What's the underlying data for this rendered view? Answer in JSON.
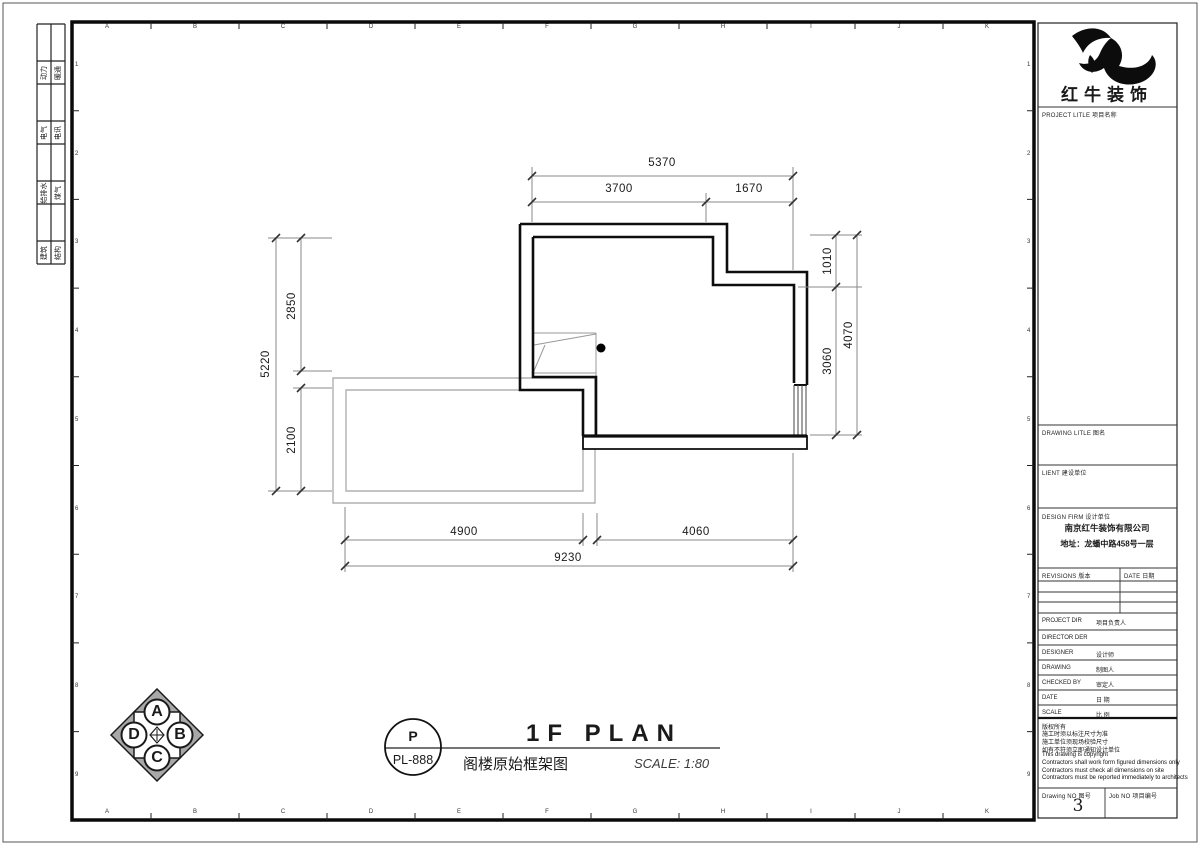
{
  "sheet": {
    "grid_letters": [
      "A",
      "B",
      "C",
      "D",
      "E",
      "F",
      "G",
      "H",
      "I",
      "J",
      "K"
    ],
    "grid_numbers": [
      "1",
      "2",
      "3",
      "4",
      "5",
      "6",
      "7",
      "8",
      "9"
    ],
    "disciplines": [
      {
        "left": "动力",
        "right": "暖通"
      },
      {
        "left": "电气",
        "right": "电讯"
      },
      {
        "left": "给排水",
        "right": "煤气"
      },
      {
        "left": "建筑",
        "right": "结构"
      }
    ]
  },
  "plan": {
    "dimension_labels": [
      {
        "text": "5370",
        "x": 662,
        "y": 163,
        "rot": 0
      },
      {
        "text": "3700",
        "x": 619,
        "y": 189,
        "rot": 0
      },
      {
        "text": "1670",
        "x": 749,
        "y": 189,
        "rot": 0
      },
      {
        "text": "5220",
        "x": 266,
        "y": 364,
        "rot": -90
      },
      {
        "text": "2850",
        "x": 292,
        "y": 306,
        "rot": -90
      },
      {
        "text": "2100",
        "x": 292,
        "y": 440,
        "rot": -90
      },
      {
        "text": "1010",
        "x": 828,
        "y": 261,
        "rot": -90
      },
      {
        "text": "3060",
        "x": 828,
        "y": 361,
        "rot": -90
      },
      {
        "text": "4070",
        "x": 849,
        "y": 335,
        "rot": -90
      },
      {
        "text": "4900",
        "x": 464,
        "y": 532,
        "rot": 0
      },
      {
        "text": "4060",
        "x": 696,
        "y": 532,
        "rot": 0
      },
      {
        "text": "9230",
        "x": 568,
        "y": 558,
        "rot": 0
      }
    ]
  },
  "compass": {
    "letters": [
      "A",
      "B",
      "C",
      "D"
    ]
  },
  "footer": {
    "stamp_top": "P",
    "stamp_no": "PL-888",
    "title": "1F PLAN",
    "subtitle": "阁楼原始框架图",
    "scale_label": "SCALE: 1:80"
  },
  "titleblock": {
    "logo_text": "红牛装饰",
    "project_title_label": "PROJECT LITLE 项目名称",
    "drawing_title_label": "DRAWING LITLE 图名",
    "client_label": "LIENT 建设单位",
    "design_firm_label": "DESIGN FIRM 设计单位",
    "design_firm_name": "南京红牛装饰有限公司",
    "design_firm_address": "地址：龙蟠中路458号一层",
    "revisions_label": "REVISIONS 版本",
    "date_col_label": "DATE 日期",
    "person_rows": [
      {
        "en": "PROJECT DIR",
        "cn": "项目负责人"
      },
      {
        "en": "DIRECTOR DER",
        "cn": ""
      },
      {
        "en": "DESIGNER",
        "cn": "设计师"
      },
      {
        "en": "DRAWING",
        "cn": "制图人"
      },
      {
        "en": "CHECKED BY",
        "cn": "审定人"
      },
      {
        "en": "DATE",
        "cn": "日  期"
      },
      {
        "en": "SCALE",
        "cn": "比  例"
      }
    ],
    "notes": [
      "版权所有",
      "施工时须以标注尺寸为准",
      "施工单位须现场校验尺寸",
      "如有不符须立即通知设计单位",
      "This drawing is copyright",
      "Contractors shall work form figured dimensions only",
      "Contractors must check all dimensions on site",
      "Contractors must be reported immediately to architects"
    ],
    "drawing_no_label": "Drawing NO 图号",
    "drawing_no_value": "3",
    "job_no_label": "Job NO 项目编号"
  }
}
